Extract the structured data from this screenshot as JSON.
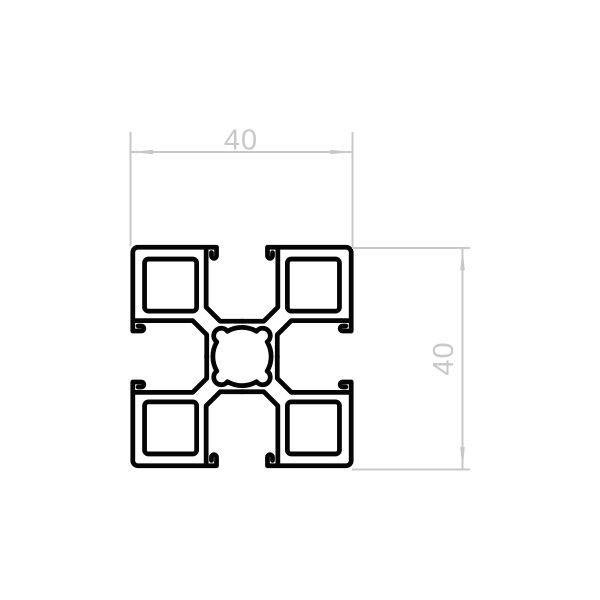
{
  "drawing": {
    "outline_color": "#050505",
    "dimension_color": "#c8c8c8",
    "dimensions": {
      "width": {
        "label": "40"
      },
      "height": {
        "label": "40"
      }
    }
  }
}
